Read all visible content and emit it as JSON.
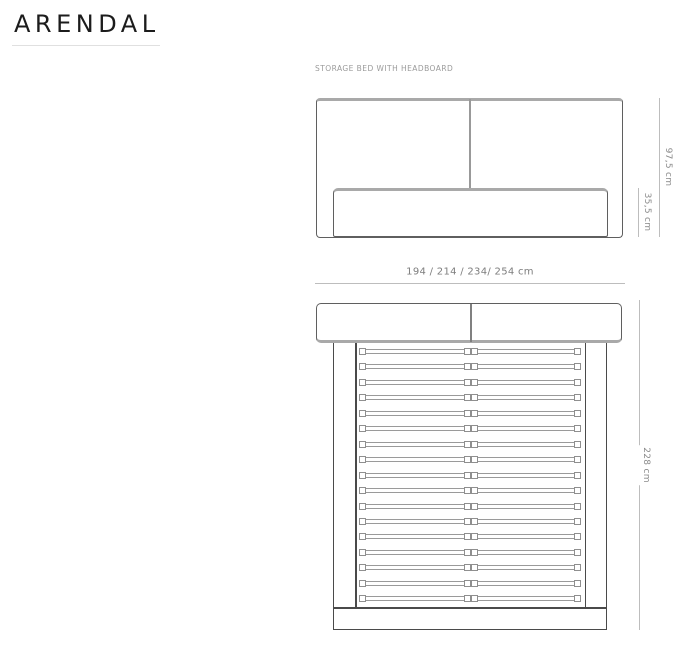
{
  "page": {
    "title": "ARENDAL",
    "subtitle": "STORAGE BED WITH HEADBOARD"
  },
  "diagram": {
    "front_view": {
      "description": "front elevation of storage bed with headboard",
      "dimensions": {
        "total_height": "97,5 cm",
        "frame_height": "35,5 cm"
      }
    },
    "top_view": {
      "description": "plan view with slat base",
      "dimensions": {
        "widths": "194 / 214 / 234/ 254 cm",
        "length": "228 cm"
      },
      "slat_rows": 17
    },
    "colors": {
      "title": "#1c1c1c",
      "subtitle": "#9b9b9b",
      "rule": "#e0e0e0",
      "outline": "#5f5f5f",
      "outline_dark": "#4a4a4a",
      "shade": "#a9a9a9",
      "slat": "#9a9a9a",
      "dim_line": "#bdbdbd",
      "dim_text": "#8a8a8a"
    }
  }
}
